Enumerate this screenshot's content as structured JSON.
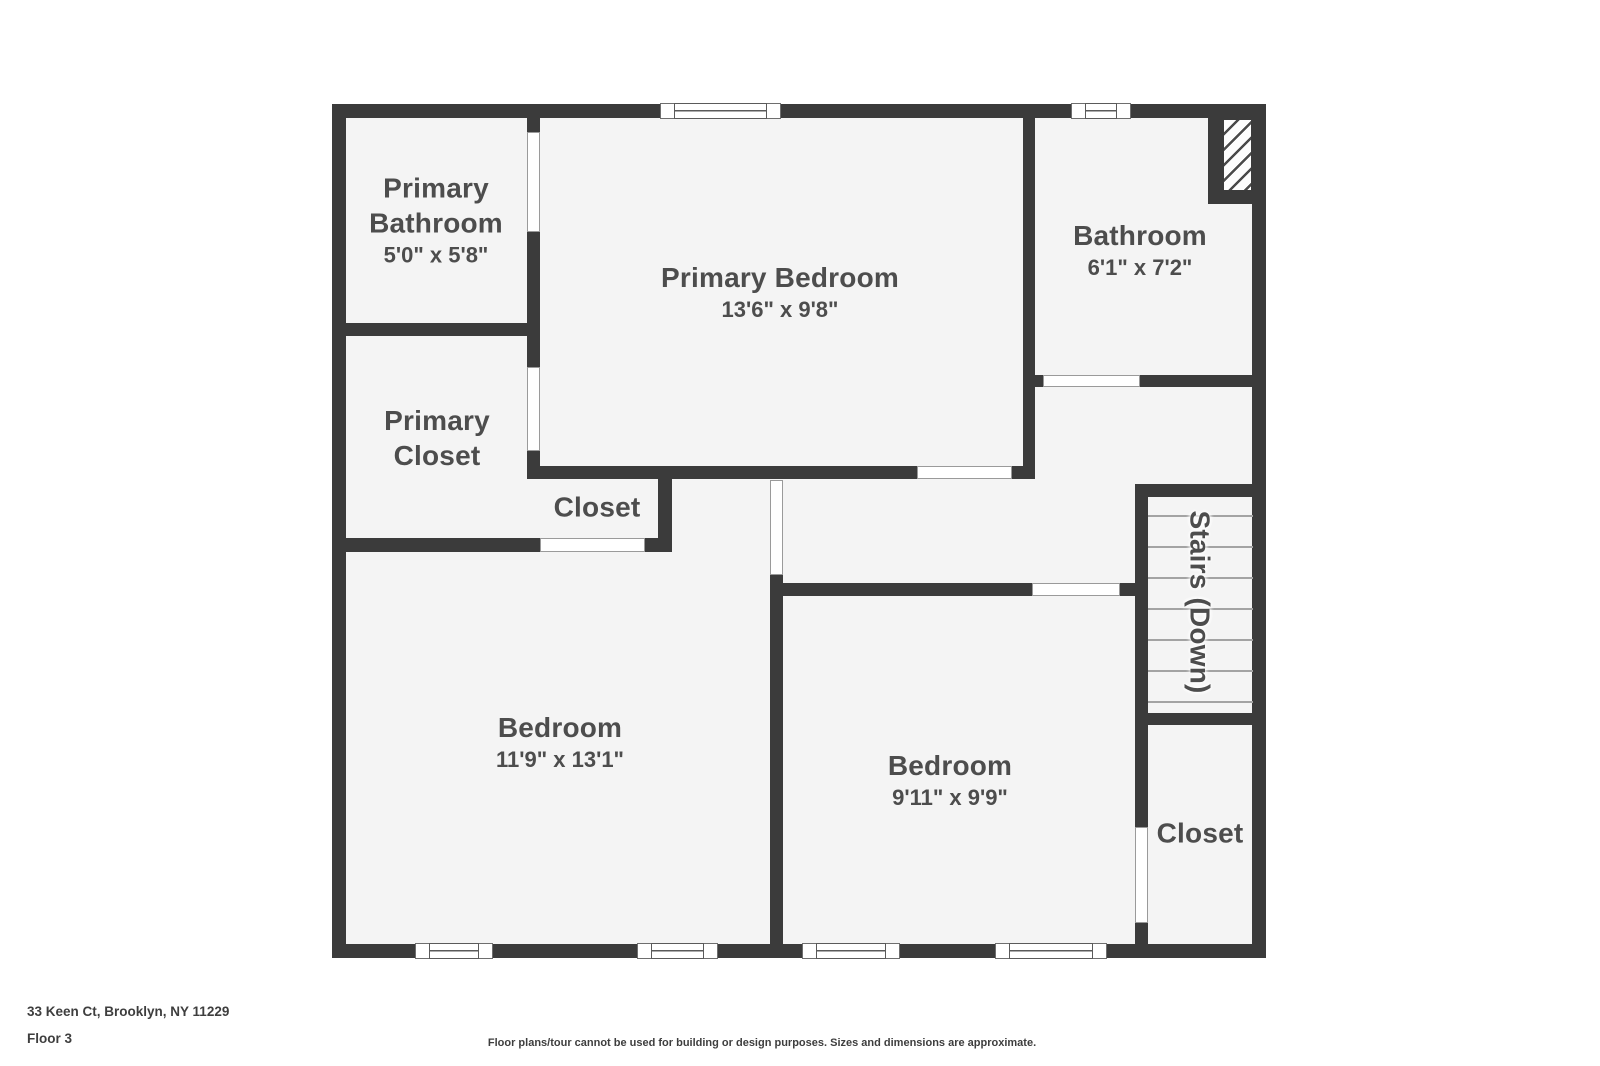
{
  "floorplan": {
    "canvas": {
      "w": 1600,
      "h": 1066
    },
    "colors": {
      "wall": "#3b3b3b",
      "floor": "#f4f4f4",
      "label": "#4d4d4d",
      "tread": "#a3a3a3",
      "door_outline": "#9a9a9a",
      "footer_text": "#3e3e3e"
    },
    "interior": {
      "x": 332,
      "y": 104,
      "w": 934,
      "h": 854
    },
    "walls": [
      {
        "x": 332,
        "y": 104,
        "w": 934,
        "h": 14
      },
      {
        "x": 332,
        "y": 944,
        "w": 934,
        "h": 14
      },
      {
        "x": 332,
        "y": 104,
        "w": 14,
        "h": 854
      },
      {
        "x": 1252,
        "y": 104,
        "w": 14,
        "h": 854
      },
      {
        "x": 332,
        "y": 323,
        "w": 208,
        "h": 13
      },
      {
        "x": 527,
        "y": 118,
        "w": 13,
        "h": 14
      },
      {
        "x": 527,
        "y": 232,
        "w": 13,
        "h": 135
      },
      {
        "x": 527,
        "y": 451,
        "w": 13,
        "h": 28
      },
      {
        "x": 332,
        "y": 538,
        "w": 208,
        "h": 14
      },
      {
        "x": 527,
        "y": 466,
        "w": 390,
        "h": 13
      },
      {
        "x": 1012,
        "y": 466,
        "w": 23,
        "h": 13
      },
      {
        "x": 658,
        "y": 466,
        "w": 14,
        "h": 86
      },
      {
        "x": 645,
        "y": 538,
        "w": 27,
        "h": 14
      },
      {
        "x": 770,
        "y": 575,
        "w": 13,
        "h": 369
      },
      {
        "x": 783,
        "y": 583,
        "w": 249,
        "h": 13
      },
      {
        "x": 1120,
        "y": 583,
        "w": 28,
        "h": 13
      },
      {
        "x": 1023,
        "y": 118,
        "w": 12,
        "h": 348
      },
      {
        "x": 1035,
        "y": 375,
        "w": 8,
        "h": 12
      },
      {
        "x": 1140,
        "y": 375,
        "w": 126,
        "h": 12
      },
      {
        "x": 1208,
        "y": 104,
        "w": 14,
        "h": 86
      },
      {
        "x": 1208,
        "y": 190,
        "w": 58,
        "h": 14
      },
      {
        "x": 1137,
        "y": 484,
        "w": 129,
        "h": 13
      },
      {
        "x": 1135,
        "y": 484,
        "w": 13,
        "h": 343
      },
      {
        "x": 1135,
        "y": 923,
        "w": 13,
        "h": 21
      },
      {
        "x": 1137,
        "y": 713,
        "w": 129,
        "h": 12
      }
    ],
    "doors": [
      {
        "name": "door-primary-bathroom",
        "x": 527,
        "y": 132,
        "w": 13,
        "h": 100
      },
      {
        "name": "door-primary-closet",
        "x": 527,
        "y": 367,
        "w": 13,
        "h": 84
      },
      {
        "name": "door-hall-closet",
        "x": 540,
        "y": 538,
        "w": 105,
        "h": 14
      },
      {
        "name": "door-primary-bedroom",
        "x": 917,
        "y": 466,
        "w": 95,
        "h": 13
      },
      {
        "name": "door-bathroom",
        "x": 1043,
        "y": 375,
        "w": 97,
        "h": 12
      },
      {
        "name": "door-bedroom-left",
        "x": 770,
        "y": 480,
        "w": 13,
        "h": 95
      },
      {
        "name": "door-bedroom-right",
        "x": 1032,
        "y": 583,
        "w": 88,
        "h": 13
      },
      {
        "name": "door-bottom-closet",
        "x": 1135,
        "y": 827,
        "w": 13,
        "h": 96
      }
    ],
    "windows": [
      {
        "name": "window-primary-bedroom",
        "x": 660,
        "y": 103,
        "w": 121,
        "h": 16
      },
      {
        "name": "window-bathroom",
        "x": 1071,
        "y": 103,
        "w": 60,
        "h": 16
      },
      {
        "name": "window-bedroom-left-1",
        "x": 415,
        "y": 943,
        "w": 78,
        "h": 16
      },
      {
        "name": "window-bedroom-left-2",
        "x": 637,
        "y": 943,
        "w": 81,
        "h": 16
      },
      {
        "name": "window-bedroom-right-1",
        "x": 802,
        "y": 943,
        "w": 98,
        "h": 16
      },
      {
        "name": "window-bedroom-right-2",
        "x": 995,
        "y": 943,
        "w": 112,
        "h": 16
      }
    ],
    "hatch_shaft": {
      "x": 1222,
      "y": 118,
      "w": 31,
      "h": 74
    },
    "stairs": {
      "treads_x": 1148,
      "treads_w": 105,
      "tread_ys": [
        515,
        546,
        577,
        608,
        639,
        670,
        701
      ]
    },
    "rooms": [
      {
        "id": "primary-bathroom",
        "name": [
          "Primary",
          "Bathroom"
        ],
        "dims": "5'0\" x 5'8\"",
        "cx": 436,
        "cy": 220
      },
      {
        "id": "primary-bedroom",
        "name": [
          "Primary Bedroom"
        ],
        "dims": "13'6\" x 9'8\"",
        "cx": 780,
        "cy": 292
      },
      {
        "id": "bathroom",
        "name": [
          "Bathroom"
        ],
        "dims": "6'1\" x 7'2\"",
        "cx": 1140,
        "cy": 250
      },
      {
        "id": "primary-closet",
        "name": [
          "Primary",
          "Closet"
        ],
        "dims": null,
        "cx": 437,
        "cy": 438
      },
      {
        "id": "hall-closet",
        "name": [
          "Closet"
        ],
        "dims": null,
        "cx": 597,
        "cy": 507
      },
      {
        "id": "stairs-down",
        "name": [
          "Stairs (Down)"
        ],
        "dims": null,
        "cx": 1200,
        "cy": 602,
        "rotate": 90
      },
      {
        "id": "bedroom-left",
        "name": [
          "Bedroom"
        ],
        "dims": "11'9\" x 13'1\"",
        "cx": 560,
        "cy": 742
      },
      {
        "id": "bedroom-right",
        "name": [
          "Bedroom"
        ],
        "dims": "9'11\" x 9'9\"",
        "cx": 950,
        "cy": 780
      },
      {
        "id": "bottom-closet",
        "name": [
          "Closet"
        ],
        "dims": null,
        "cx": 1200,
        "cy": 833
      }
    ],
    "footer": {
      "address": "33 Keen Ct, Brooklyn, NY 11229",
      "floor_label": "Floor 3",
      "disclaimer": "Floor plans/tour cannot be used for building or design purposes. Sizes and dimensions are approximate."
    }
  }
}
